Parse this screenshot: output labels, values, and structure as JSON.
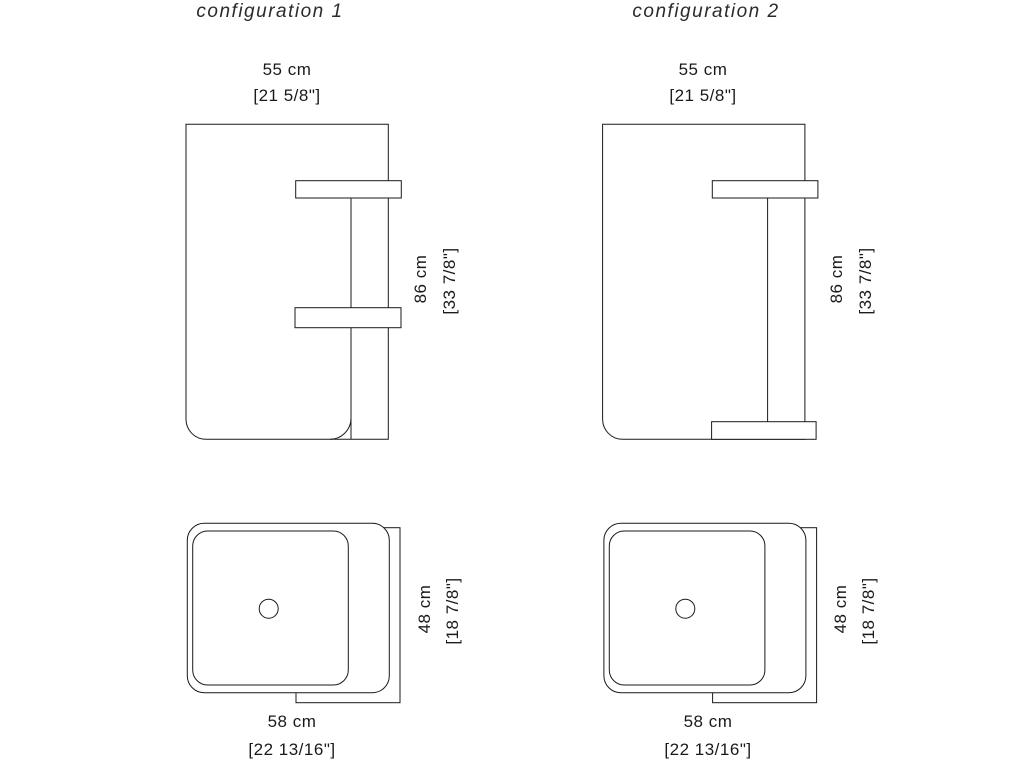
{
  "document": {
    "background_color": "#ffffff",
    "line_color": "#1a1a1a",
    "kind": "furniture dimension drawing"
  },
  "configurations": [
    {
      "title": "configuration 1",
      "front_view": {
        "width_cm": "55 cm",
        "width_in": "[21 5/8\"]",
        "height_cm": "86 cm",
        "height_in": "[33 7/8\"]"
      },
      "top_view": {
        "depth_cm": "48 cm",
        "depth_in": "[18 7/8\"]",
        "width_cm": "58 cm",
        "width_in": "[22 13/16\"]"
      }
    },
    {
      "title": "configuration 2",
      "front_view": {
        "width_cm": "55 cm",
        "width_in": "[21 5/8\"]",
        "height_cm": "86 cm",
        "height_in": "[33 7/8\"]"
      },
      "top_view": {
        "depth_cm": "48 cm",
        "depth_in": "[18 7/8\"]",
        "width_cm": "58 cm",
        "width_in": "[22 13/16\"]"
      }
    }
  ]
}
